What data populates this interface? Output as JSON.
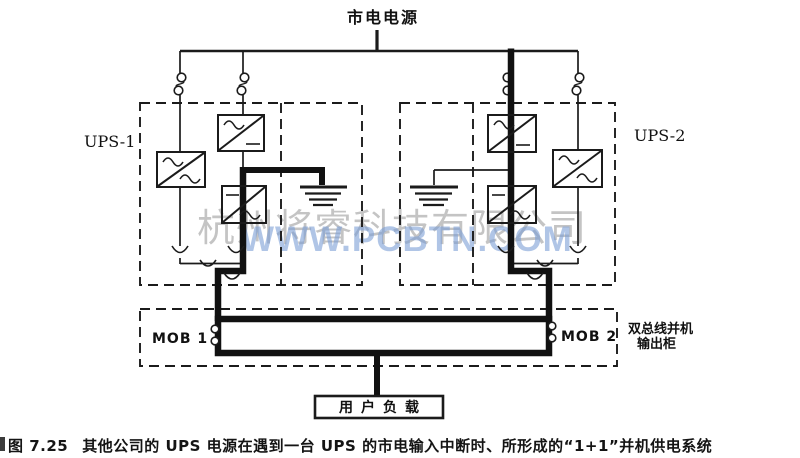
{
  "diagram": {
    "mains_label": "市电电源",
    "ups1_label": "UPS-1",
    "ups2_label": "UPS-2",
    "mob1_label": "MOB 1",
    "mob2_label": "MOB 2",
    "output_cabinet_line1": "双总线并机",
    "output_cabinet_line2": "输出柜",
    "load_label": "用户负载"
  },
  "watermark": {
    "company": "杭州将睿科技有限公司",
    "website": "WWW.PCBTN.COM"
  },
  "caption": {
    "figure_no": "图 7.25",
    "text": "其他公司的 UPS 电源在遇到一台 UPS 的市电输入中断时、所形成的“1+1”并机供电系统"
  },
  "colors": {
    "line": "#1b1b1b",
    "thick_path": "#111111",
    "watermark_gray": "#949494",
    "watermark_blue": "#7c9fd6"
  }
}
